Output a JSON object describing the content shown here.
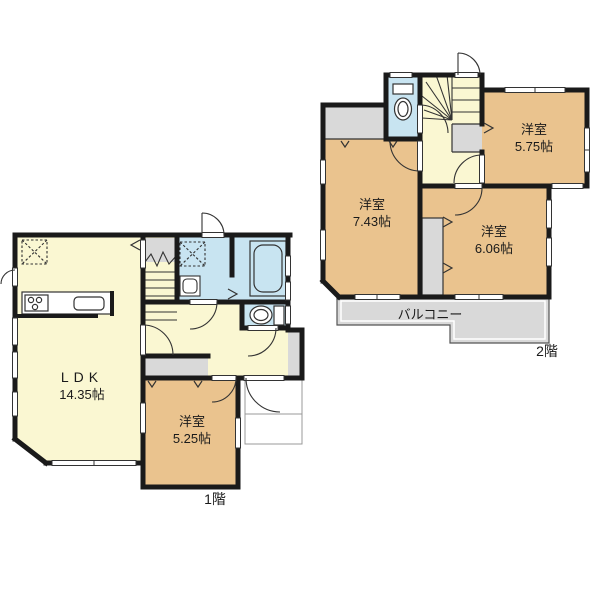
{
  "meta": {
    "type": "floor-plan",
    "plan_title": "間取り図"
  },
  "palette": {
    "wall": "#1a1a1a",
    "room_yellow": "#FAF7D2",
    "room_tan": "#EAC38E",
    "wet_blue": "#C8E4F1",
    "gray": "#D9D9D9",
    "bg": "#FFFFFF"
  },
  "floor1": {
    "label": "1階",
    "ldk": {
      "name": "LDK",
      "size": "14.35帖"
    },
    "bedroom": {
      "name": "洋室",
      "size": "5.25帖"
    },
    "fixtures": [
      "kitchen-stove",
      "kitchen-sink",
      "refrigerator-space",
      "washing-machine-space",
      "vanity-sink",
      "bathtub",
      "toilet",
      "staircase",
      "entrance-door",
      "closet"
    ]
  },
  "floor2": {
    "label": "2階",
    "bedroom_a": {
      "name": "洋室",
      "size": "7.43帖"
    },
    "bedroom_b": {
      "name": "洋室",
      "size": "6.06帖"
    },
    "bedroom_c": {
      "name": "洋室",
      "size": "5.75帖"
    },
    "balcony": {
      "label": "バルコニー"
    },
    "fixtures": [
      "toilet",
      "staircase",
      "closet",
      "closet"
    ]
  }
}
